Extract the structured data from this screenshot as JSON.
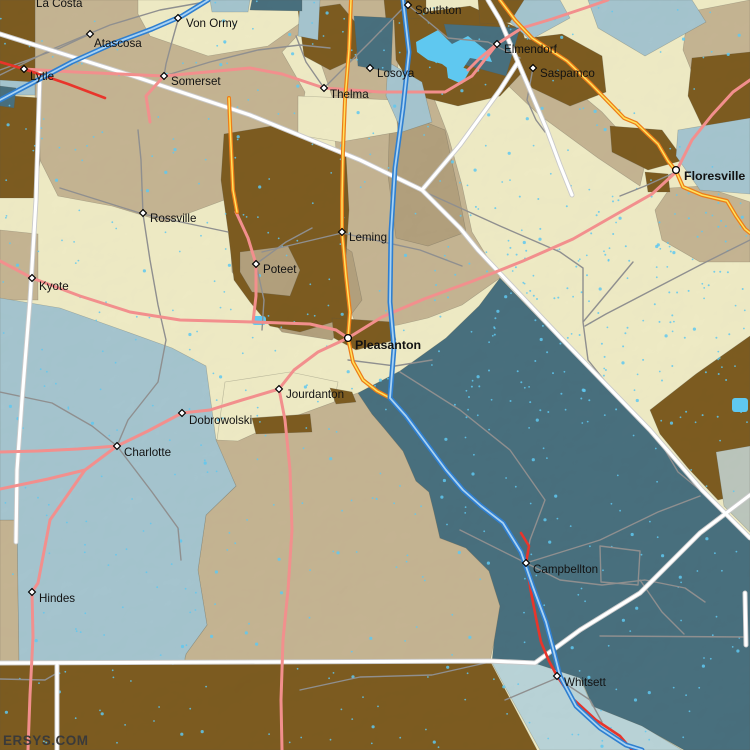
{
  "map": {
    "watermark": "ERSYS.COM",
    "palette": {
      "cream": "#F0ECC6",
      "tan": "#C6B593",
      "tan_dark": "#B3A17D",
      "brown": "#7D5C20",
      "light_blue": "#A6C6D0",
      "pale_teal": "#BAD5D9",
      "sage": "#BCC7BD",
      "dark_teal": "#49707E",
      "water": "#5FC8F0",
      "road_pink": "#F28F8D",
      "road_red": "#E8352B",
      "road_orange": "#ED7D18",
      "road_orange_center": "#FFE35C",
      "road_blue": "#2F7FD0",
      "road_blue_center": "#A8D2F2",
      "road_white": "#FFFFFF",
      "road_white_casing": "#C9C9C9",
      "road_gray": "#8F8F8F",
      "label_color": "#121212",
      "watermark_color": "#3A3A3A"
    },
    "marker_styles": {
      "town": "diamond",
      "city": "circle"
    },
    "towns": [
      {
        "name": "La Costa",
        "x": 70,
        "y": 2,
        "marker": "none",
        "bold": false,
        "lx": 36,
        "ly": 7
      },
      {
        "name": "Von Ormy",
        "x": 178,
        "y": 18,
        "marker": "diamond",
        "bold": false,
        "lx": 186,
        "ly": 27
      },
      {
        "name": "Atascosa",
        "x": 90,
        "y": 34,
        "marker": "diamond",
        "bold": false,
        "lx": 94,
        "ly": 47
      },
      {
        "name": "Lytle",
        "x": 24,
        "y": 69,
        "marker": "diamond",
        "bold": false,
        "lx": 30,
        "ly": 80
      },
      {
        "name": "Somerset",
        "x": 164,
        "y": 76,
        "marker": "diamond",
        "bold": false,
        "lx": 171,
        "ly": 85
      },
      {
        "name": "Southton",
        "x": 408,
        "y": 5,
        "marker": "diamond",
        "bold": false,
        "lx": 415,
        "ly": 14
      },
      {
        "name": "Losoya",
        "x": 370,
        "y": 68,
        "marker": "diamond",
        "bold": false,
        "lx": 377,
        "ly": 77
      },
      {
        "name": "Thelma",
        "x": 324,
        "y": 88,
        "marker": "diamond",
        "bold": false,
        "lx": 330,
        "ly": 98
      },
      {
        "name": "Elmendorf",
        "x": 497,
        "y": 44,
        "marker": "diamond",
        "bold": false,
        "lx": 504,
        "ly": 53
      },
      {
        "name": "Saspamco",
        "x": 533,
        "y": 68,
        "marker": "diamond",
        "bold": false,
        "lx": 540,
        "ly": 77
      },
      {
        "name": "Floresville",
        "x": 676,
        "y": 170,
        "marker": "circle",
        "bold": true,
        "lx": 684,
        "ly": 180
      },
      {
        "name": "Rossville",
        "x": 143,
        "y": 213,
        "marker": "diamond",
        "bold": false,
        "lx": 150,
        "ly": 222
      },
      {
        "name": "Leming",
        "x": 342,
        "y": 232,
        "marker": "diamond",
        "bold": false,
        "lx": 349,
        "ly": 241
      },
      {
        "name": "Poteet",
        "x": 256,
        "y": 264,
        "marker": "diamond",
        "bold": false,
        "lx": 263,
        "ly": 273
      },
      {
        "name": "Kyote",
        "x": 32,
        "y": 278,
        "marker": "diamond",
        "bold": false,
        "lx": 39,
        "ly": 290
      },
      {
        "name": "Pleasanton",
        "x": 348,
        "y": 338,
        "marker": "circle",
        "bold": true,
        "lx": 355,
        "ly": 349
      },
      {
        "name": "Jourdanton",
        "x": 279,
        "y": 389,
        "marker": "diamond",
        "bold": false,
        "lx": 286,
        "ly": 398
      },
      {
        "name": "Dobrowolski",
        "x": 182,
        "y": 413,
        "marker": "diamond",
        "bold": false,
        "lx": 189,
        "ly": 424
      },
      {
        "name": "Charlotte",
        "x": 117,
        "y": 446,
        "marker": "diamond",
        "bold": false,
        "lx": 124,
        "ly": 456
      },
      {
        "name": "Hindes",
        "x": 32,
        "y": 592,
        "marker": "diamond",
        "bold": false,
        "lx": 39,
        "ly": 602
      },
      {
        "name": "Campbellton",
        "x": 526,
        "y": 563,
        "marker": "diamond",
        "bold": false,
        "lx": 533,
        "ly": 573
      },
      {
        "name": "Whitsett",
        "x": 557,
        "y": 676,
        "marker": "diamond",
        "bold": false,
        "lx": 564,
        "ly": 686
      }
    ]
  }
}
